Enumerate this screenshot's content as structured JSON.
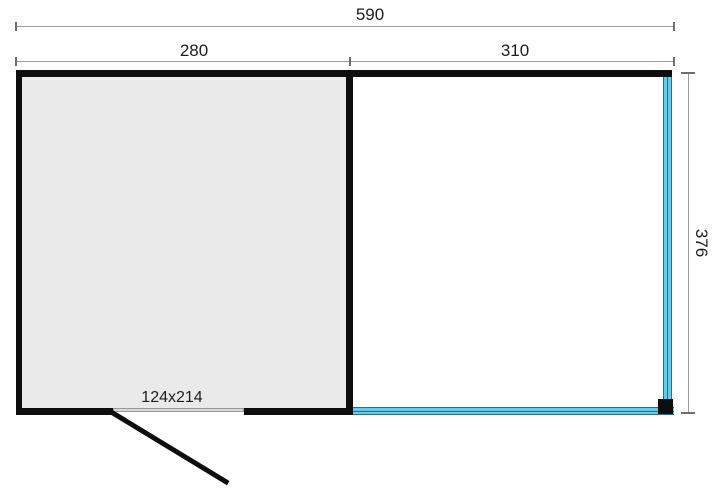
{
  "drawing": {
    "type": "floor-plan",
    "dimensions": {
      "overall_width": "590",
      "room_width": "280",
      "veranda_width": "310",
      "depth": "376",
      "door_size": "124x214"
    }
  },
  "colors": {
    "background": "#ffffff",
    "wall": "#0e0e0e",
    "room_fill": "#eaeaea",
    "dim_line": "#9c9c9c",
    "dim_tick": "#6e6e6e",
    "dim_text": "#1d1d1d",
    "glass_fill": "#66cbe9",
    "glass_edge": "#2b6e8d",
    "door_leaf_fill": "#d8d8d8",
    "door_leaf_edge": "#9a9a9a"
  }
}
